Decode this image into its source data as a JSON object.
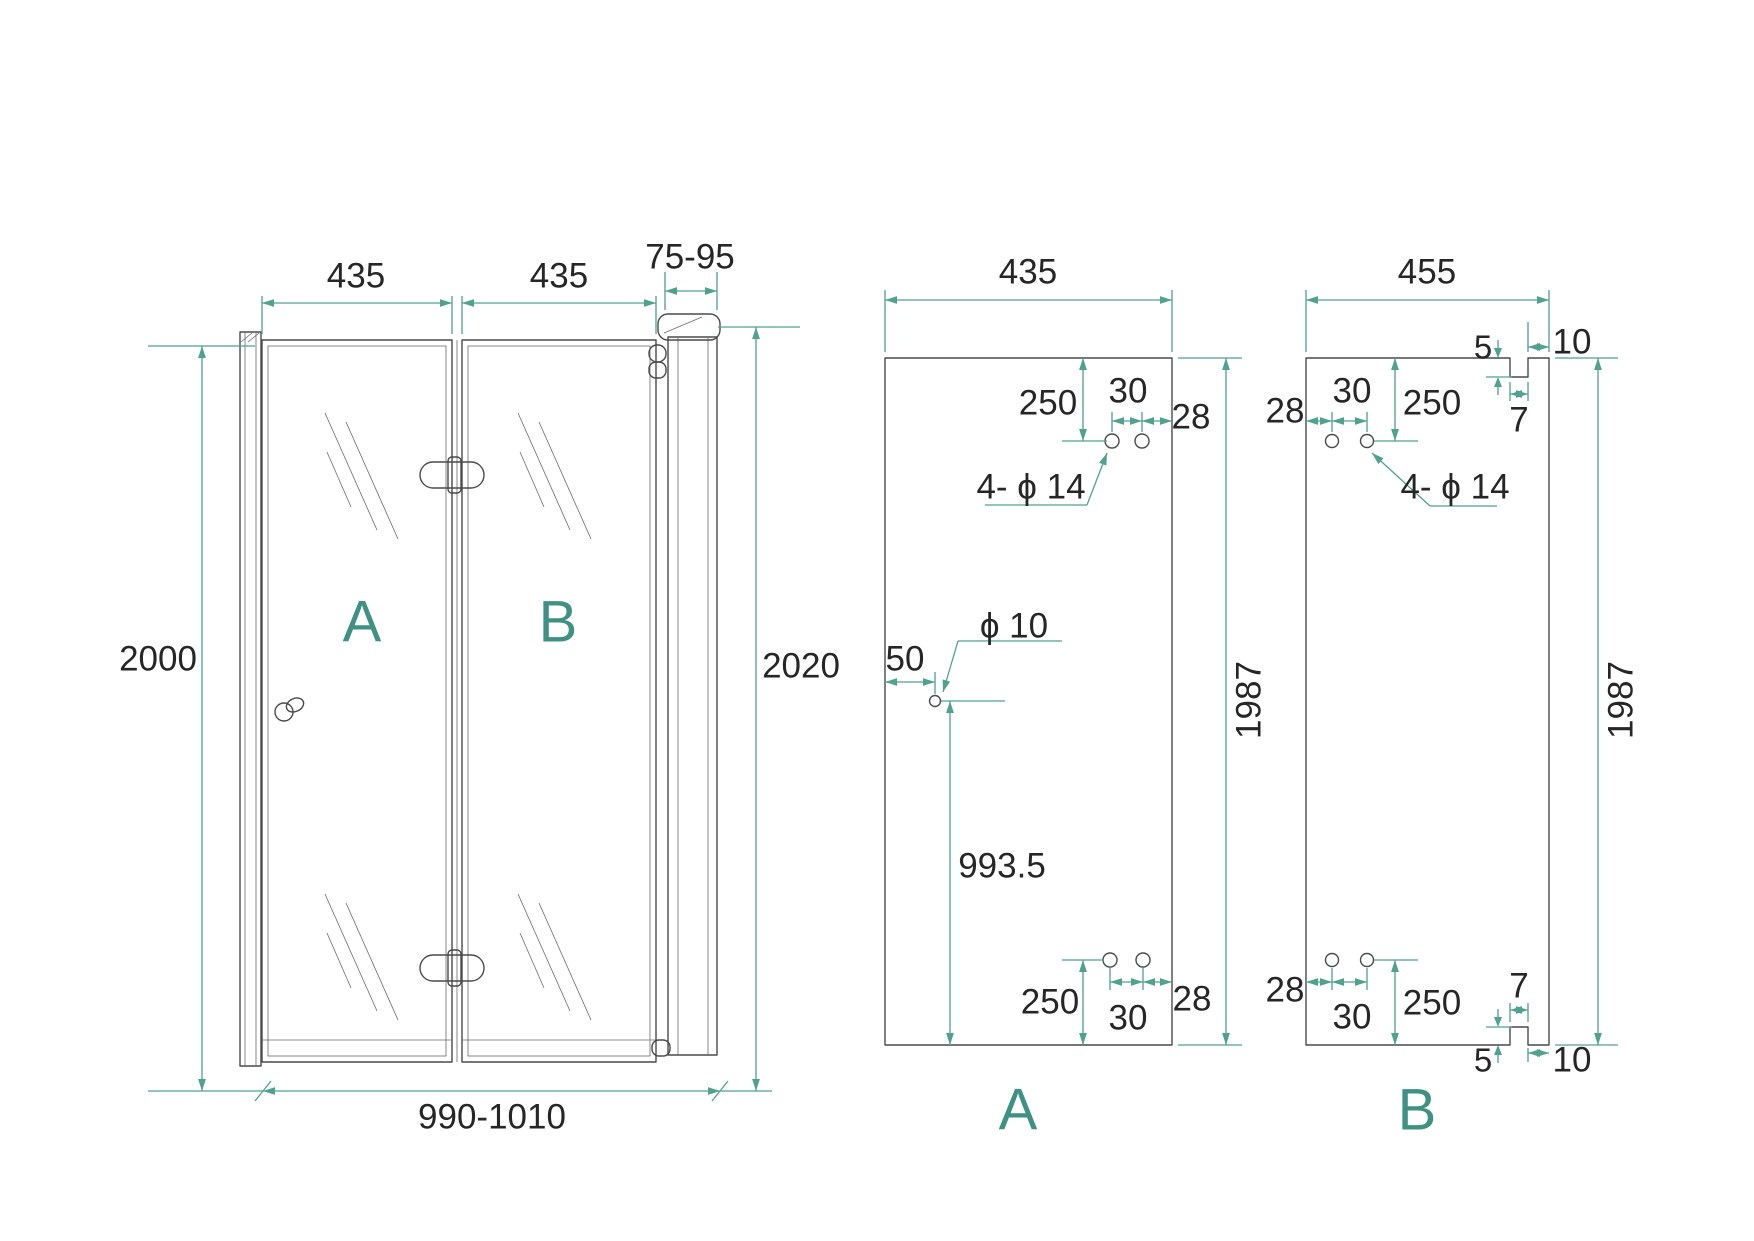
{
  "title": "Folding shower door technical drawing",
  "colors": {
    "dimension_line": "#4fa28e",
    "panel_label": "#3f9183",
    "drawing_line": "#4a4a4a",
    "dimension_text": "#262626",
    "background": "#ffffff"
  },
  "assembled": {
    "panel_a_width": "435",
    "panel_b_width": "435",
    "wall_profile_range": "75-95",
    "height_left": "2000",
    "height_right": "2020",
    "total_width_range": "990-1010",
    "panel_a_label": "A",
    "panel_b_label": "B"
  },
  "panel_a": {
    "label": "A",
    "width": "435",
    "height": "1987",
    "holes_label": "4- ϕ 14",
    "top": {
      "offset": "250",
      "pitch": "30",
      "edge": "28"
    },
    "bottom": {
      "offset": "250",
      "pitch": "30",
      "edge": "28"
    },
    "handle": {
      "label": "ϕ 10",
      "from_edge": "50",
      "from_bottom": "993.5"
    }
  },
  "panel_b": {
    "label": "B",
    "width": "455",
    "height": "1987",
    "holes_label": "4- ϕ 14",
    "top": {
      "offset": "250",
      "pitch": "30",
      "edge": "28"
    },
    "bottom": {
      "offset": "250",
      "pitch": "30",
      "edge": "28"
    },
    "top_notch": {
      "depth": "5",
      "width": "7",
      "to_edge": "10"
    },
    "bottom_notch": {
      "depth": "5",
      "width": "7",
      "to_edge": "10"
    }
  }
}
